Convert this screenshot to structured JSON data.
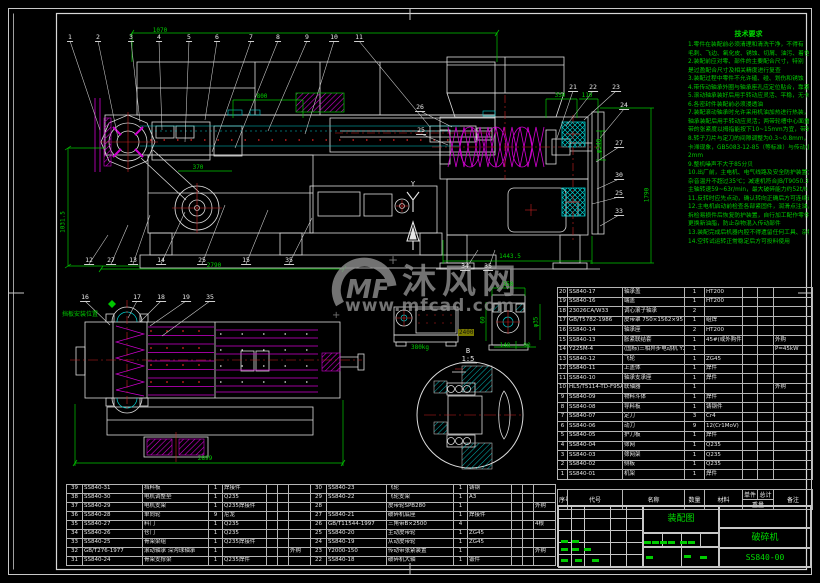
{
  "sheet": {
    "colors": {
      "bg": "#000000",
      "line": "#dcdcdc",
      "cyan": "#00cfcf",
      "magenta": "#d000d0",
      "red": "#cc2222",
      "green": "#00cc00",
      "gray": "#8f8f8f"
    },
    "watermark": {
      "logo": "MF",
      "brand": "沐风网",
      "url": "www.mfcad.com"
    }
  },
  "notes": {
    "title": "技术要求",
    "lines": [
      "1.零件在装配前必须清理和清洗干净，不得有",
      "毛刺、飞边、氧化皮、锈蚀、切屑、油污、着色剂和灰尘等",
      "2.装配前应对零、部件的主要配合尺寸，特别",
      "是过盈配合尺寸及相关精度进行复查",
      "3.装配过程中零件不允许磕、碰、划伤和锈蚀",
      "4.带传动轴承外圈与轴承座孔应定位贴合，靠紧轴肩",
      "5.滚动轴承装好后用手转动应灵活、平稳，无卡滞",
      "6.各密封件装配前必须浸透油",
      "7.装配滚动轴承时允许采用机油加热进行热装，油温不得超过100℃，",
      "轴承装配后用手转动应灵活；两带轮槽中心面重合度不少于1mm，",
      "带的张紧度以拇指能按下10~15mm为宜，带轮装配后应进行静平衡",
      "8.转子刀片与定刀的间隙调整为0.3~0.8mm，调整时刀刃不得相碰，不得有",
      "卡滞现象，GB5083-12-85（等标准）与传动小车间隙间隔",
      "2mm",
      "9.整机噪声不大于85分贝",
      "10.出厂前，主电机、电气线路及安全防护装置；空载试运转应平稳，",
      "杂音温升不超过35℃；减速机符合JB/T9050.3-1999规定",
      "主轴转速59~63r/min，最大破碎能力约52t/h",
      "11.反转时应先点动，确认转向正确后方可连续运转",
      "12.主电机启动前检查各部紧固件，润滑点注油，机内不得有杂物，",
      "拆检易损件后恢复防护装置，自行加工配作零件须经检验合格后装机，",
      "更换新油脂，防止杂物混入传动部件",
      "13.装配完成后机器内腔不得遗留任何工具、杂物",
      "14.空转试运转正常稳定后方可投料使用"
    ]
  },
  "views": {
    "front": {
      "callouts_top": [
        "1",
        "2",
        "3",
        "4",
        "5",
        "6",
        "7",
        "8",
        "9",
        "10",
        "11"
      ],
      "callouts_bottom": [
        "12",
        "27",
        "13",
        "14",
        "25",
        "15",
        "35"
      ],
      "dims": {
        "top": "1070",
        "inner": "800",
        "left": "1031.5",
        "mid": "370",
        "bottom": "2790"
      }
    },
    "side": {
      "callouts_left": [
        "26",
        "25"
      ],
      "callouts_top": [
        "21",
        "22",
        "23"
      ],
      "callouts_right": [
        "24",
        "27",
        "30",
        "25",
        "33"
      ],
      "callouts_bottom": [
        "34",
        "35"
      ],
      "dims": {
        "t1": "350",
        "t2": "110",
        "dia": "φ340",
        "right": "1790",
        "bottom": "1443.5"
      },
      "axis_label": "Y"
    },
    "plan": {
      "callouts_top": [
        "16",
        "17",
        "18",
        "19",
        "35"
      ],
      "anno": "挡板安装位置",
      "dims": {
        "bottom": "2899"
      }
    },
    "detail": {
      "label": "B",
      "scale": "1:5",
      "weight": "380kg",
      "highlight": "2400",
      "dims": {
        "v2_top": "350",
        "v2_left": "60",
        "v2_dia": "φ35",
        "v2_b1": "140",
        "v2_b2": "90"
      }
    }
  },
  "bom_right": {
    "headers": [
      "序号",
      "代号",
      "名称",
      "数量",
      "材料",
      "单件",
      "总计",
      "备注"
    ],
    "weight_header": "重量",
    "rows": [
      [
        "20",
        "SS840-17",
        "轴承盖",
        "1",
        "HT200",
        "",
        "",
        ""
      ],
      [
        "19",
        "SS840-16",
        "端盖",
        "1",
        "HT200",
        "",
        "",
        ""
      ],
      [
        "18",
        "23026CA/W33",
        "调心滚子轴承",
        "2",
        "",
        "",
        "",
        ""
      ],
      [
        "17",
        "GB/T5782-1986",
        "皮带罩 750×1562×95",
        "1",
        "组焊",
        "",
        "",
        ""
      ],
      [
        "16",
        "SS840-14",
        "轴承座",
        "2",
        "HT200",
        "",
        "",
        ""
      ],
      [
        "15",
        "SS840-13",
        "胀紧联结套",
        "1",
        "45#(或外购件)",
        "",
        "",
        "外购"
      ],
      [
        "14",
        "Y225M-4",
        "(国标)三相异步电动机 Y225M",
        "1",
        "",
        "",
        "",
        "P=45kW"
      ],
      [
        "13",
        "SS840-12",
        "飞轮",
        "1",
        "ZG45",
        "",
        "",
        ""
      ],
      [
        "12",
        "SS840-11",
        "上盖体",
        "1",
        "焊件",
        "",
        "",
        ""
      ],
      [
        "11",
        "SS840-10",
        "轴承支承座",
        "1",
        "焊件",
        "",
        "",
        ""
      ],
      [
        "10",
        "HL5/T5114-TD-F95A",
        "联轴器",
        "1",
        "",
        "",
        "",
        "外购"
      ],
      [
        "9",
        "SS840-09",
        "物料斗体",
        "1",
        "焊件",
        "",
        "",
        ""
      ],
      [
        "8",
        "SS840-08",
        "导料板",
        "1",
        "铸钢件",
        "",
        "",
        ""
      ],
      [
        "7",
        "SS840-07",
        "定刀",
        "3",
        "Cr4",
        "",
        "",
        ""
      ],
      [
        "6",
        "SS840-06",
        "动刀",
        "9",
        "12(Cr1MoV)",
        "",
        "",
        ""
      ],
      [
        "5",
        "SS840-05",
        "护刀板",
        "1",
        "焊件",
        "",
        "",
        ""
      ],
      [
        "4",
        "SS840-04",
        "筛网",
        "1",
        "Q235",
        "",
        "",
        ""
      ],
      [
        "3",
        "SS840-03",
        "筛网架",
        "1",
        "Q235",
        "",
        "",
        ""
      ],
      [
        "2",
        "SS840-02",
        "侧板",
        "1",
        "Q235",
        "",
        "",
        ""
      ],
      [
        "1",
        "SS840-01",
        "机架",
        "1",
        "焊件",
        "",
        "",
        ""
      ]
    ]
  },
  "bom_bottom_left": {
    "rows": [
      [
        "39",
        "SS840-31",
        "挡料板",
        "1",
        "焊接件",
        ""
      ],
      [
        "38",
        "SS840-30",
        "电机调整垫",
        "1",
        "Q235",
        ""
      ],
      [
        "37",
        "SS840-29",
        "电机支架",
        "1",
        "Q235焊接件",
        ""
      ],
      [
        "36",
        "SS840-28",
        "单向轮",
        "9",
        "尼龙",
        ""
      ],
      [
        "35",
        "SS840-27",
        "料门",
        "1",
        "Q235",
        ""
      ],
      [
        "34",
        "SS840-26",
        "仓门",
        "1",
        "Q235",
        ""
      ],
      [
        "33",
        "SS840-25",
        "骨架梁组",
        "1",
        "Q235焊接件",
        ""
      ],
      [
        "32",
        "GB/T276-1977",
        "滚动轴承 深沟球轴承",
        "1",
        "",
        "外购"
      ],
      [
        "31",
        "SS840-24",
        "骨架支撑梁",
        "1",
        "Q235焊件",
        ""
      ]
    ]
  },
  "bom_bottom_right": {
    "rows": [
      [
        "30",
        "SS840-23",
        "飞轮",
        "1",
        "铸钢",
        ""
      ],
      [
        "29",
        "SS840-22",
        "飞轮支架",
        "1",
        "A3",
        ""
      ],
      [
        "28",
        "",
        "皮带轮SPB280",
        "1",
        "",
        "外购"
      ],
      [
        "27",
        "SS840-21",
        "破碎机底座",
        "1",
        "焊接件",
        ""
      ],
      [
        "26",
        "GB/T11544-1997",
        "三角带B×2500",
        "4",
        "",
        "4根"
      ],
      [
        "25",
        "SS840-20",
        "主动皮带轮",
        "1",
        "ZG45",
        ""
      ],
      [
        "24",
        "SS840-19",
        "从动皮带轮",
        "1",
        "ZG45",
        ""
      ],
      [
        "23",
        "Y2000-150",
        "传动带张紧装置",
        "1",
        "",
        "外购"
      ],
      [
        "22",
        "SS840-18",
        "破碎机大轴",
        "1",
        "锻件",
        ""
      ]
    ]
  },
  "title_block": {
    "drawing_type": "装配图",
    "product": "破碎机",
    "drawing_no": "SS840-00"
  }
}
